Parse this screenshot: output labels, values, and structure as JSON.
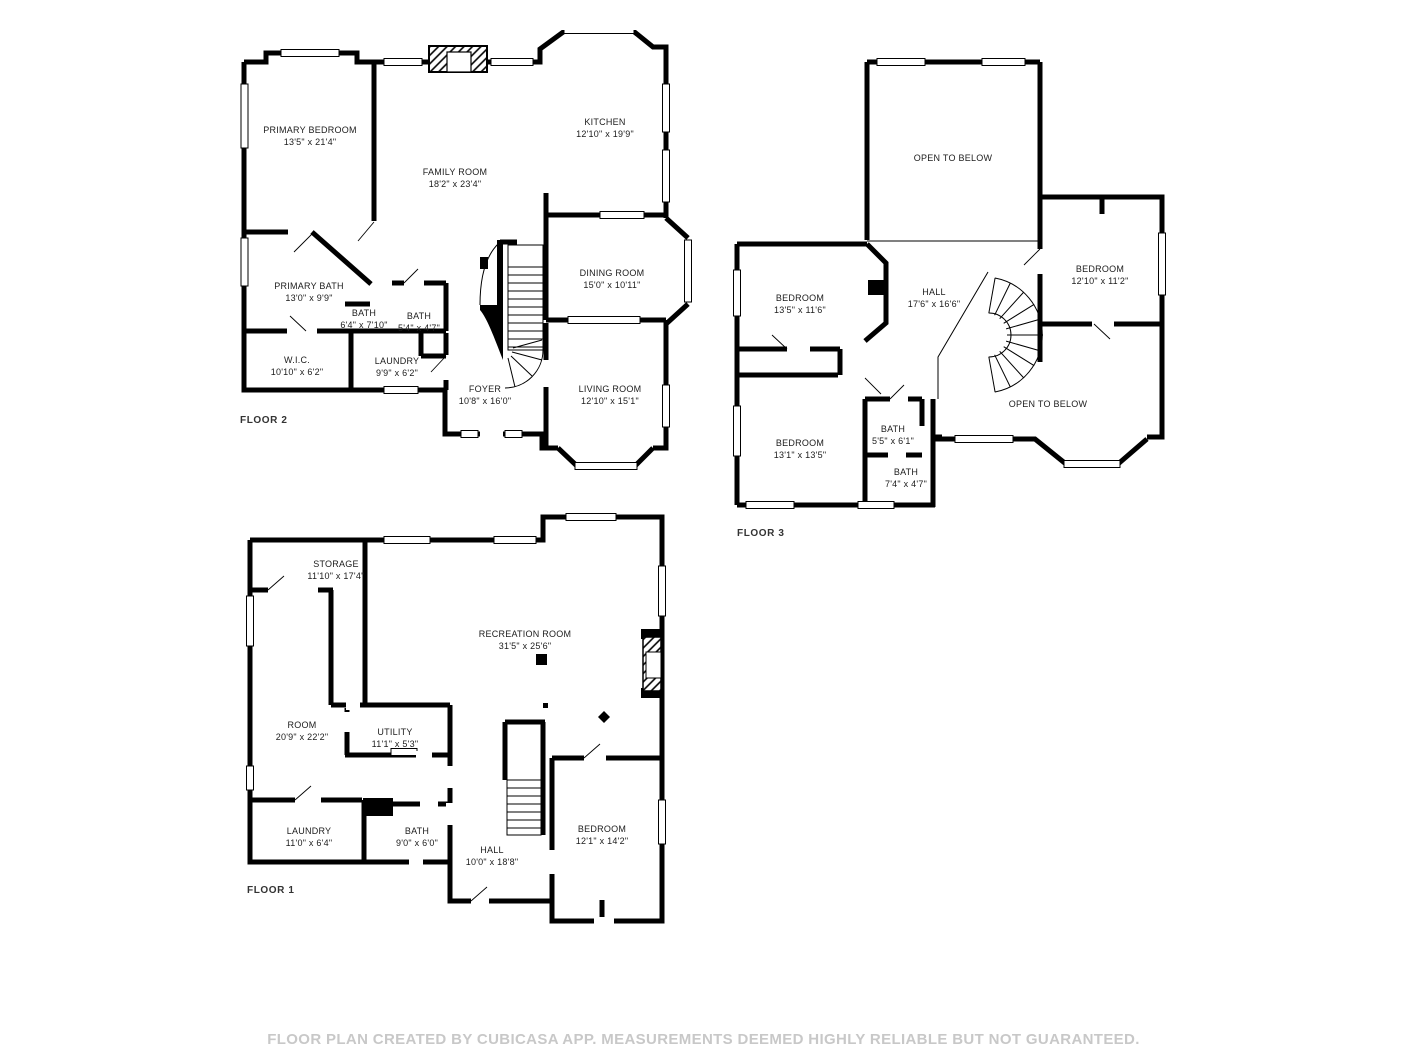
{
  "disclaimer": "FLOOR PLAN CREATED BY CUBICASA APP. MEASUREMENTS DEEMED HIGHLY RELIABLE BUT NOT GUARANTEED.",
  "floors": [
    {
      "label": "FLOOR 2",
      "rooms": [
        {
          "name": "PRIMARY BEDROOM",
          "dims": "13'5\" x 21'4\""
        },
        {
          "name": "KITCHEN",
          "dims": "12'10\" x 19'9\""
        },
        {
          "name": "FAMILY ROOM",
          "dims": "18'2\" x 23'4\""
        },
        {
          "name": "DINING ROOM",
          "dims": "15'0\" x 10'11\""
        },
        {
          "name": "PRIMARY BATH",
          "dims": "13'0\" x 9'9\""
        },
        {
          "name": "BATH",
          "dims": "6'4\" x 7'10\""
        },
        {
          "name": "BATH",
          "dims": "5'4\" x 4'7\""
        },
        {
          "name": "W.I.C.",
          "dims": "10'10\" x 6'2\""
        },
        {
          "name": "LAUNDRY",
          "dims": "9'9\" x 6'2\""
        },
        {
          "name": "FOYER",
          "dims": "10'8\" x 16'0\""
        },
        {
          "name": "LIVING ROOM",
          "dims": "12'10\" x 15'1\""
        }
      ]
    },
    {
      "label": "FLOOR 3",
      "rooms": [
        {
          "name": "OPEN TO BELOW",
          "dims": ""
        },
        {
          "name": "BEDROOM",
          "dims": "13'5\" x 11'6\""
        },
        {
          "name": "HALL",
          "dims": "17'6\" x 16'6\""
        },
        {
          "name": "BEDROOM",
          "dims": "12'10\" x 11'2\""
        },
        {
          "name": "BEDROOM",
          "dims": "13'1\" x 13'5\""
        },
        {
          "name": "BATH",
          "dims": "5'5\" x 6'1\""
        },
        {
          "name": "BATH",
          "dims": "7'4\" x 4'7\""
        },
        {
          "name": "OPEN TO BELOW",
          "dims": ""
        }
      ]
    },
    {
      "label": "FLOOR 1",
      "rooms": [
        {
          "name": "STORAGE",
          "dims": "11'10\" x 17'4\""
        },
        {
          "name": "RECREATION ROOM",
          "dims": "31'5\" x 25'6\""
        },
        {
          "name": "ROOM",
          "dims": "20'9\" x 22'2\""
        },
        {
          "name": "UTILITY",
          "dims": "11'1\" x 5'3\""
        },
        {
          "name": "LAUNDRY",
          "dims": "11'0\" x 6'4\""
        },
        {
          "name": "BATH",
          "dims": "9'0\" x 6'0\""
        },
        {
          "name": "HALL",
          "dims": "10'0\" x 18'8\""
        },
        {
          "name": "BEDROOM",
          "dims": "12'1\" x 14'2\""
        }
      ]
    }
  ]
}
